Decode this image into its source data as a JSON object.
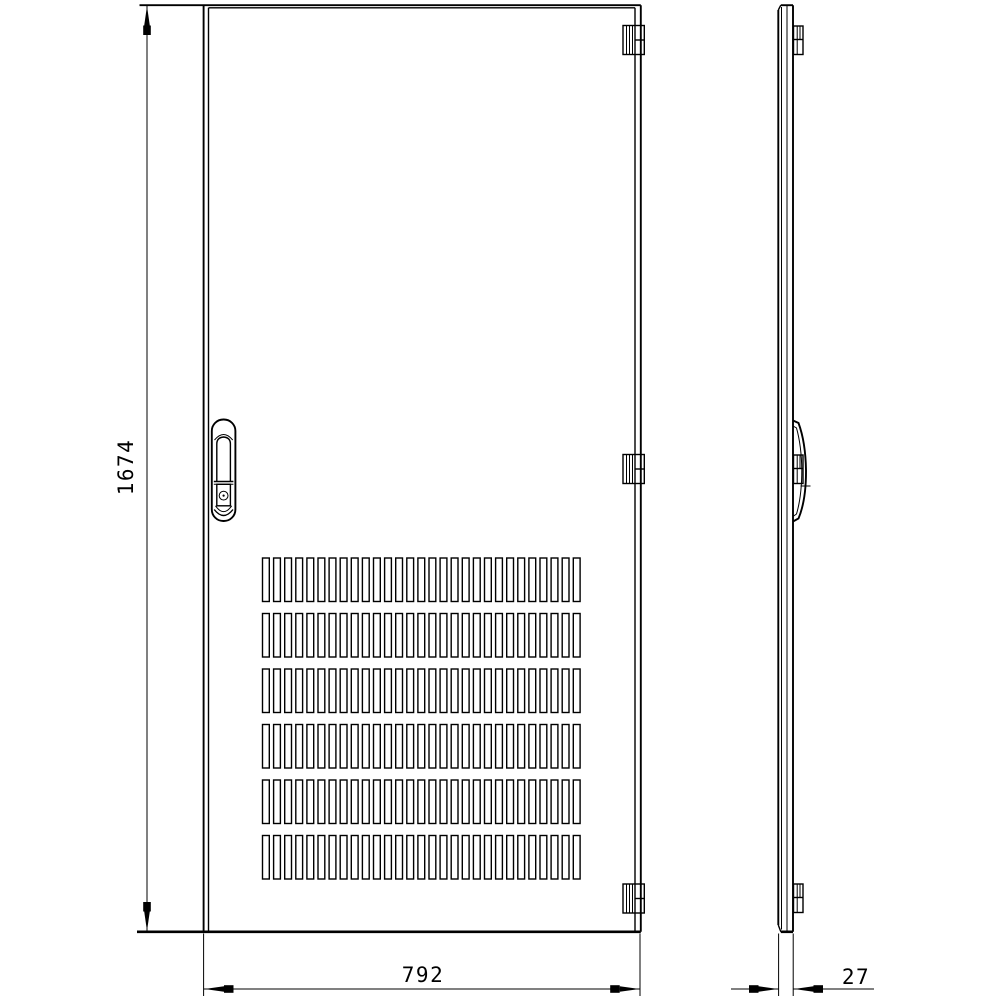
{
  "page": {
    "background_color": "#ffffff",
    "line_color": "#000000"
  },
  "drawing": {
    "type": "technical-drawing",
    "subject": "vented cabinet door, front and side orthographic views",
    "dimensions": {
      "height": {
        "value": "1674"
      },
      "width": {
        "value": "792"
      },
      "depth": {
        "value": "27"
      }
    },
    "front_view": {
      "hinge_count": 3,
      "has_handle_lock": true
    },
    "side_view": {
      "hinge_count": 3,
      "has_handle": true
    },
    "vent_grid": {
      "rows": 6,
      "columns": 29
    }
  }
}
